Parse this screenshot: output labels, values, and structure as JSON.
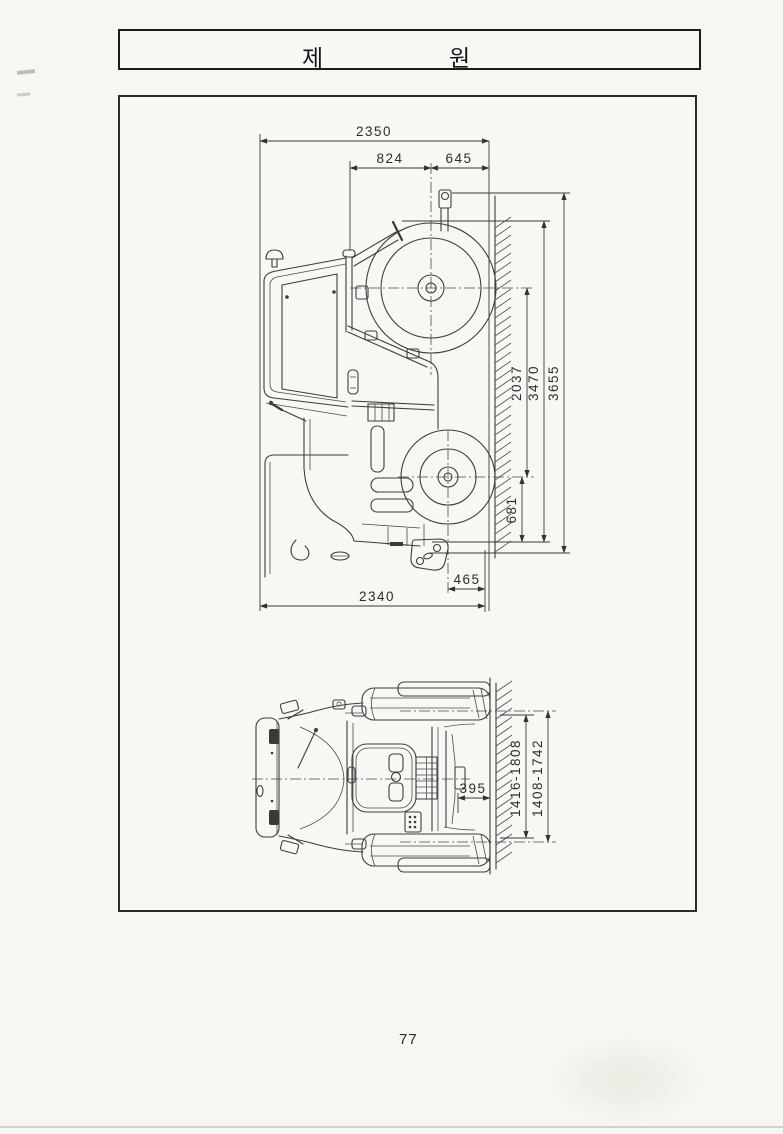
{
  "title": {
    "left": "제",
    "right": "원"
  },
  "page_number": "77",
  "dims": {
    "d2350": "2350",
    "d824": "824",
    "d645": "645",
    "d2037": "2037",
    "d3470": "3470",
    "d3655": "3655",
    "d681": "681",
    "d465": "465",
    "d2340": "2340",
    "d395": "395",
    "d1416_1808": "1416-1808",
    "d1408_1742": "1408-1742"
  }
}
